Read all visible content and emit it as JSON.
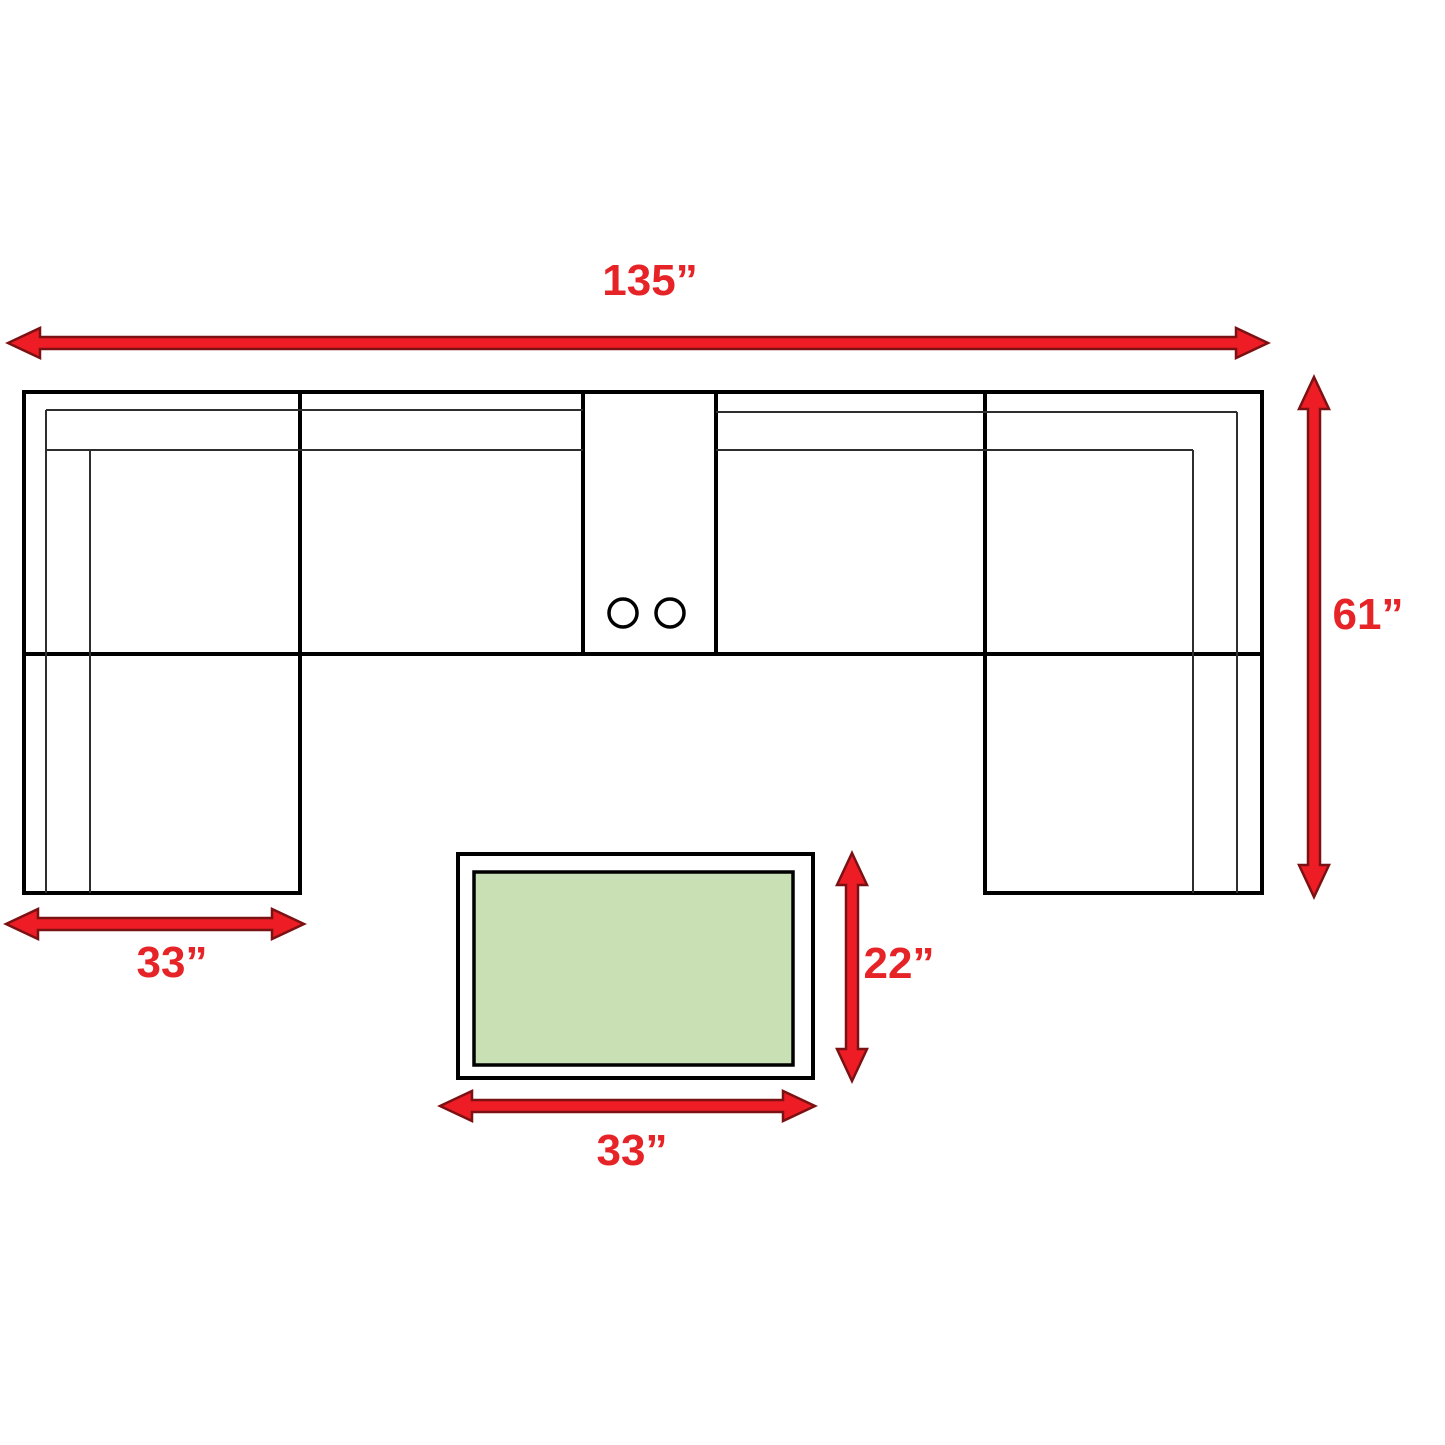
{
  "labels": {
    "sofa_width": "135”",
    "sofa_depth": "61”",
    "chaise_width": "33”",
    "table_depth": "22”",
    "table_width": "33”"
  },
  "colors": {
    "arrow_fill": "#ee1c25",
    "arrow_edge": "#7c1113",
    "label_text": "#e62428",
    "outline": "#000000",
    "table_fill": "#c9e0b4"
  }
}
